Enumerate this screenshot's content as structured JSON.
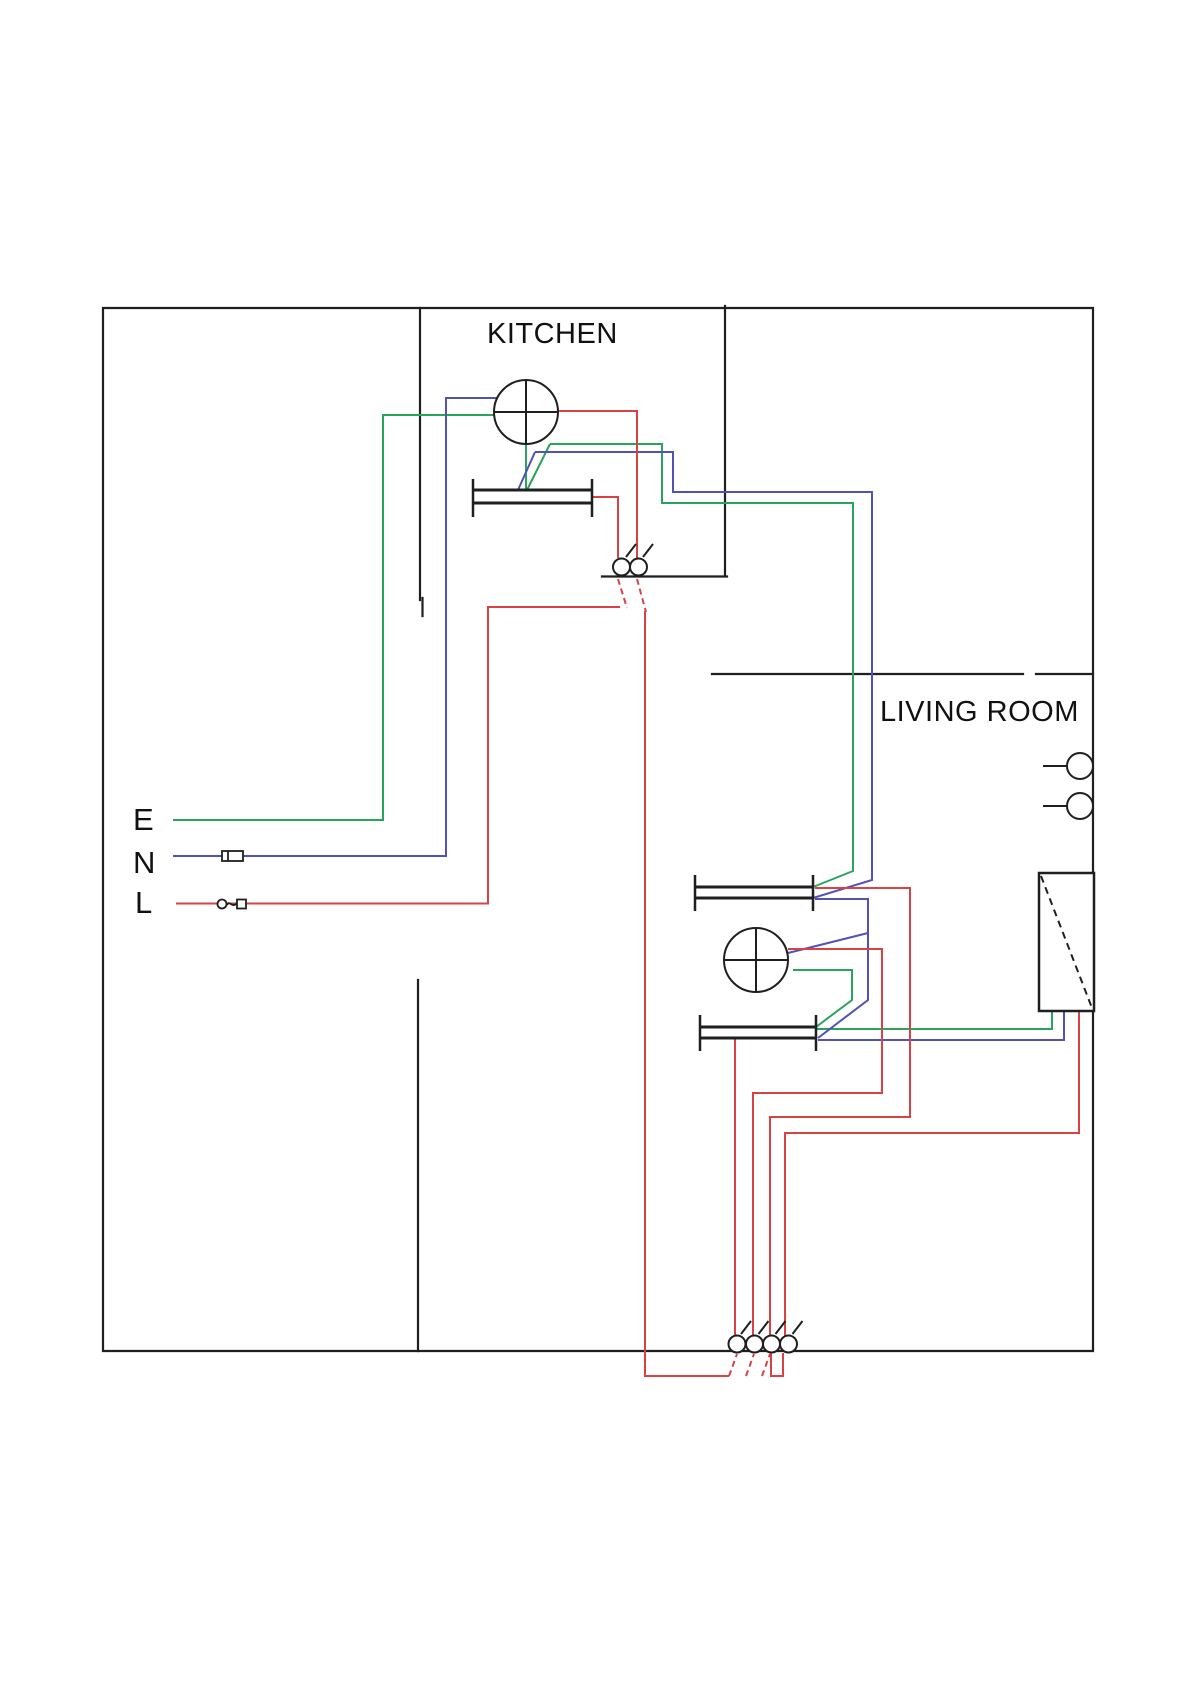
{
  "page": {
    "background": "#ffffff"
  },
  "labels": {
    "kitchen": "KITCHEN",
    "living_room": "LIVING ROOM",
    "earth": "E",
    "neutral": "N",
    "live": "L"
  },
  "colors": {
    "wall": "#1f1f1f",
    "earth_wire": "#2aa45c",
    "neutral_wire": "#5252b5",
    "live_wire": "#d94242"
  },
  "components": {
    "ceiling_roses": [
      "kitchen-ceiling-rose",
      "living-room-ceiling-rose"
    ],
    "socket_outlets": [
      "kitchen-socket-outlet",
      "living-room-socket-outlet-upper",
      "living-room-socket-outlet-lower"
    ],
    "switches": [
      "kitchen-two-gang-switch",
      "bottom-four-gang-switch"
    ],
    "wall_lights": [
      "wall-light-upper",
      "wall-light-lower"
    ],
    "other": [
      "consumer-unit",
      "neutral-fuse-link",
      "live-fuse-link"
    ]
  }
}
